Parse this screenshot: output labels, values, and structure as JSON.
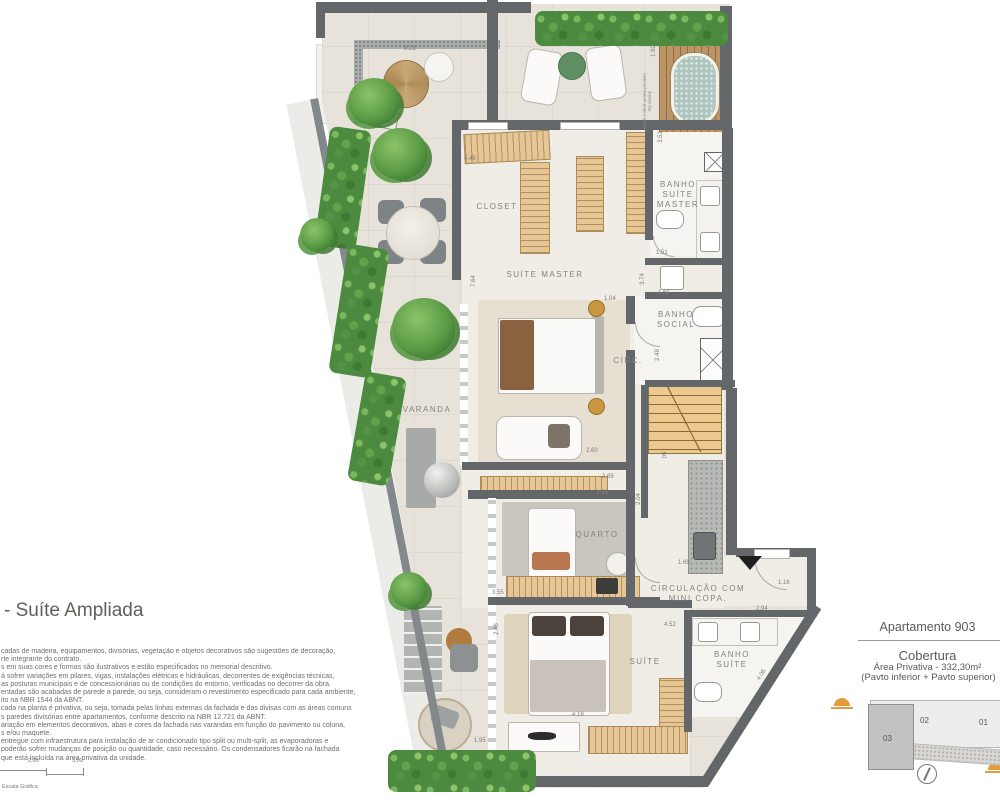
{
  "left_panel": {
    "heading": "- Suíte Ampliada",
    "disclaimer_lines": [
      "cadas de madeira, equipamentos, divisórias, vegetação e objetos decorativos são sugestões de decoração,",
      "rte integrante do contrato.",
      "s em suas cores e formas são ilustrativos e estão especificados no memorial descritivo.",
      "á sofrer variações em pilares, vigas, instalações elétricas e hidráulicas, decorrentes de exigências técnicas,",
      "as posturas municipais e de concessionárias ou de condições do entorno, verificadas no decorrer da obra.",
      "entadas são acabadas de parede a parede, ou seja, consideram o revestimento especificado para cada ambiente,",
      "ito na NBR 1544 da ABNT.",
      "cada na planta é privativa, ou seja, tomada pelas linhas externas da fachada e das divisas com as áreas comuns",
      "s paredes divisórias entre apartamentos, conforme descrito na NBR 12.721 da ABNT.",
      "ariação em elementos decorativos, abas e cores da fachada nas varandas em função do pavimento ou coluna,",
      "s e/ou maquete.",
      "entregue com infraestrutura para instalação de ar condicionado tipo split ou multi-split, as evaporadoras e",
      "poderão sofrer mudanças de posição ou quantidade, caso necessário. Os condensadores ficarão na fachada",
      "que está incluída na área privativa da unidade."
    ],
    "scale_bar": {
      "tick1": "2,00",
      "tick2": "3,00",
      "caption": "Escala Gráfica"
    }
  },
  "info_panel": {
    "apartment": "Apartamento 903",
    "type": "Cobertura",
    "area": "Área Privativa -  332,30m²",
    "floors": "(Pavto inferior + Pavto superior)",
    "keyplan": {
      "unit1": "01",
      "unit2": "02",
      "unit3": "03"
    }
  },
  "plan": {
    "rooms": [
      "CLOSET",
      "SUÍTE MASTER",
      "BANHO SUÍTE MASTER",
      "BANHO SOCIAL",
      "CIRC.",
      "VARANDA",
      "QUARTO",
      "CIRCULAÇÃO COM MINI COPA.",
      "SUÍTE",
      "BANHO SUÍTE"
    ],
    "dimensions": [
      "8.23",
      "1.90",
      "4.48",
      "3.51",
      "1.51",
      "1.61",
      "2.48",
      "7.64",
      "3.74",
      "1.04",
      "2.60",
      "2.69",
      "3.58",
      "2.04",
      "3.55",
      "2.46",
      "1.69",
      "1.16",
      "2.94",
      "4.52",
      "4.18",
      "4.06",
      "1.95",
      "05"
    ],
    "ofuro_note": "Ofurô e deck acima previsto My choice"
  },
  "colors": {
    "wall": "#63676a",
    "accent_orange": "#e39b3c",
    "hedge_green": "#4c8a3f"
  }
}
